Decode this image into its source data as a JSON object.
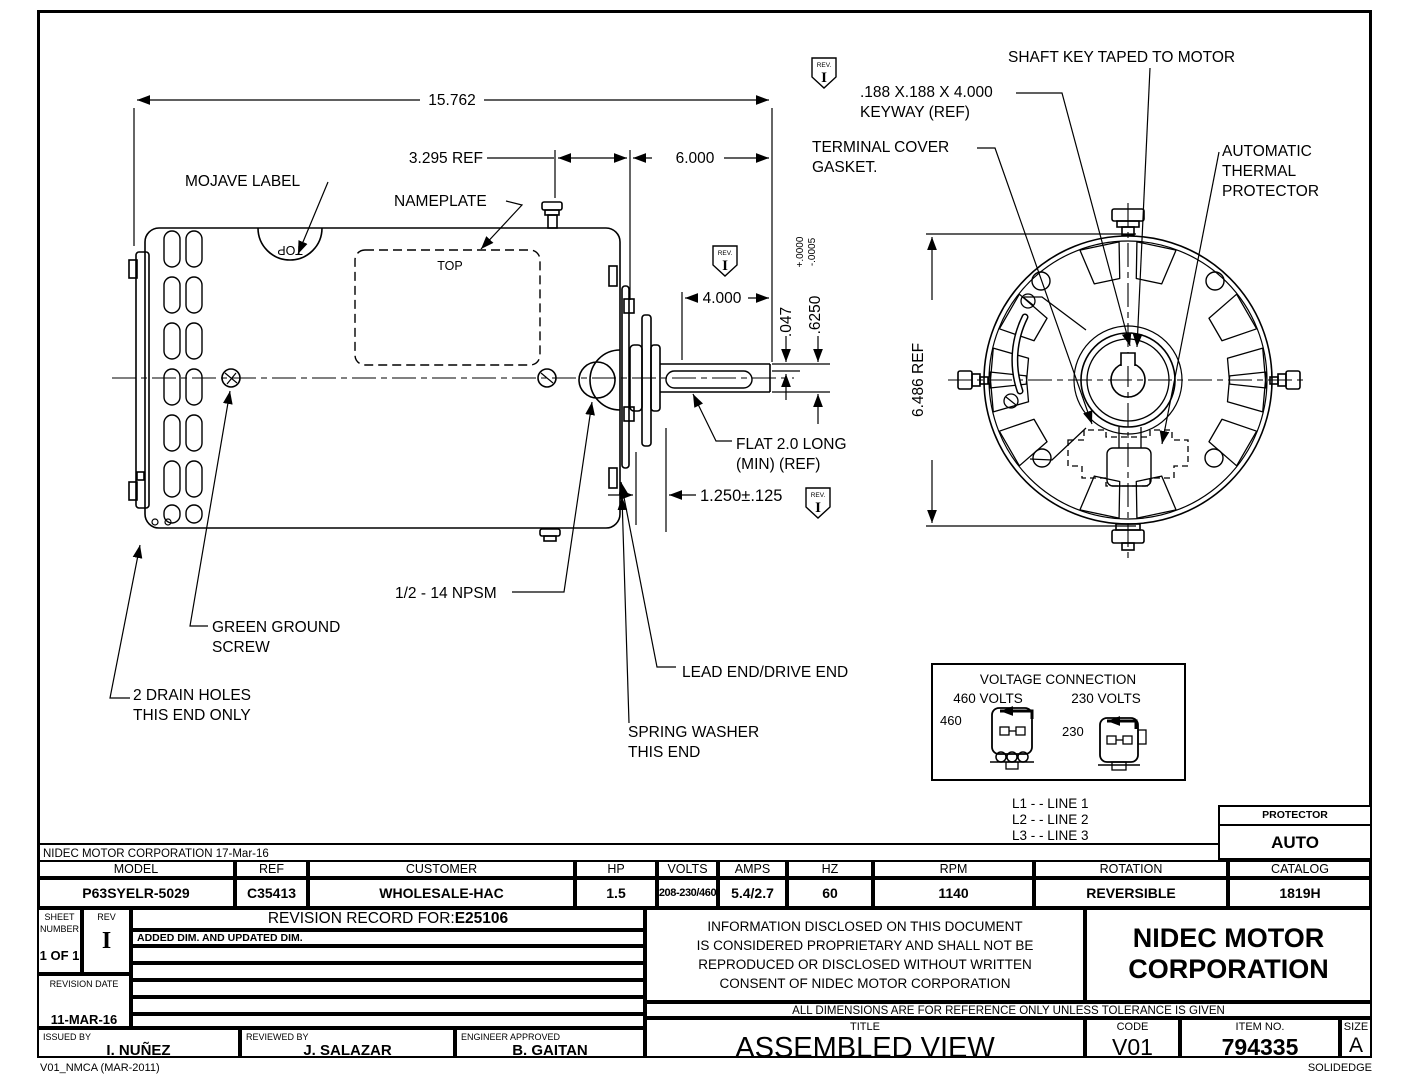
{
  "colors": {
    "line": "#000000",
    "background": "#ffffff"
  },
  "corp_note": "NIDEC MOTOR CORPORATION 17-Mar-16",
  "drawing": {
    "labels": {
      "dim_overall": "15.762",
      "dim_3295": "3.295 REF",
      "dim_6000": "6.000",
      "dim_4000": "4.000",
      "dim_047": ".047",
      "dim_625": ".6250",
      "tol_plus": "+.0000",
      "tol_minus": "-.0005",
      "dim_6486": "6.486  REF",
      "dim_125": "1.250±.125",
      "mojave": "MOJAVE LABEL",
      "nameplate": "NAMEPLATE",
      "top": "TOP",
      "flat_l1": "FLAT 2.0 LONG",
      "flat_l2": "(MIN) (REF)",
      "npsm": "1/2 - 14 NPSM",
      "ground_l1": "GREEN GROUND",
      "ground_l2": "SCREW",
      "drain_l1": "2 DRAIN HOLES",
      "drain_l2": "THIS END ONLY",
      "lead_end": "LEAD END/DRIVE END",
      "spring_l1": "SPRING WASHER",
      "spring_l2": "THIS END",
      "shaft_key": "SHAFT KEY TAPED TO MOTOR",
      "keyway_l1": ".188 X.188 X 4.000",
      "keyway_l2": "KEYWAY (REF)",
      "terminal_l1": "TERMINAL COVER",
      "terminal_l2": "GASKET.",
      "thermal_l1": "AUTOMATIC",
      "thermal_l2": "THERMAL",
      "thermal_l3": "PROTECTOR",
      "rev_tag": "REV.",
      "rev_letter": "I"
    },
    "voltage": {
      "title": "VOLTAGE CONNECTION",
      "h460": "460 VOLTS",
      "h230": "230 VOLTS",
      "v460": "460",
      "v230": "230"
    },
    "legend": [
      "L1 - - LINE 1",
      "L2 - - LINE 2",
      "L3 - - LINE 3"
    ]
  },
  "protector": {
    "label": "PROTECTOR",
    "value": "AUTO"
  },
  "spec": {
    "cols": [
      {
        "label": "MODEL",
        "value": "P63SYELR-5029"
      },
      {
        "label": "REF",
        "value": "C35413"
      },
      {
        "label": "CUSTOMER",
        "value": "WHOLESALE-HAC"
      },
      {
        "label": "HP",
        "value": "1.5"
      },
      {
        "label": "VOLTS",
        "value": "208-230/460"
      },
      {
        "label": "AMPS",
        "value": "5.4/2.7"
      },
      {
        "label": "HZ",
        "value": "60"
      },
      {
        "label": "RPM",
        "value": "1140"
      },
      {
        "label": "ROTATION",
        "value": "REVERSIBLE"
      },
      {
        "label": "CATALOG",
        "value": "1819H"
      }
    ]
  },
  "tb": {
    "sheet_label1": "SHEET",
    "sheet_label2": "NUMBER",
    "sheet_value": "1 OF 1",
    "rev_label": "REV",
    "rev_value": "I",
    "rec_label": "REVISION RECORD FOR:",
    "rec_number": "E25106",
    "rec_note": "ADDED DIM. AND UPDATED DIM.",
    "date_label": "REVISION DATE",
    "date_value": "11-MAR-16",
    "issued_label": "ISSUED BY",
    "issued_value": "I. NUÑEZ",
    "reviewed_label": "REVIEWED BY",
    "reviewed_value": "J. SALAZAR",
    "engineer_label": "ENGINEER APPROVED",
    "engineer_value": "B. GAITAN",
    "disclaimer": [
      "INFORMATION DISCLOSED ON THIS DOCUMENT",
      "IS CONSIDERED PROPRIETARY AND SHALL NOT BE",
      "REPRODUCED OR DISCLOSED WITHOUT WRITTEN",
      "CONSENT OF NIDEC MOTOR CORPORATION"
    ],
    "company1": "NIDEC MOTOR",
    "company2": "CORPORATION",
    "tol_note": "ALL DIMENSIONS ARE FOR REFERENCE ONLY UNLESS TOLERANCE IS GIVEN",
    "title_label": "TITLE",
    "title_value": "ASSEMBLED VIEW",
    "code_label": "CODE",
    "code_value": "V01",
    "item_label": "ITEM NO.",
    "item_value": "794335",
    "size_label": "SIZE",
    "size_value": "A"
  },
  "footer": {
    "left": "V01_NMCA (MAR-2011)",
    "right": "SOLIDEDGE"
  }
}
